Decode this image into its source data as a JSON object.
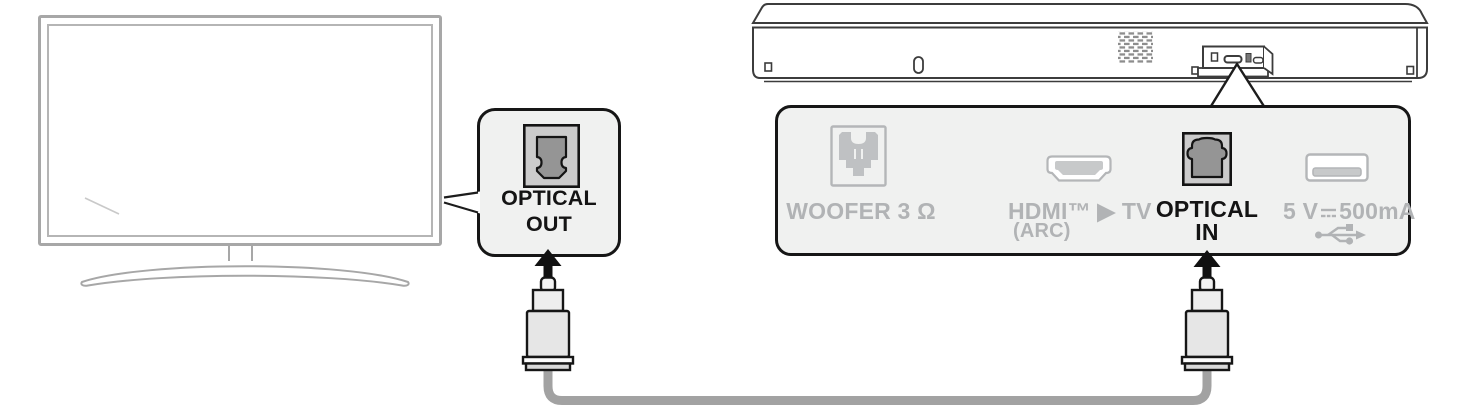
{
  "callout": {
    "line1": "OPTICAL",
    "line2": "OUT"
  },
  "panel": {
    "woofer_label": "WOOFER 3 Ω",
    "hdmi_label": "HDMI™ ▶ TV",
    "hdmi_sublabel": "(ARC)",
    "optical_line1": "OPTICAL",
    "optical_line2": "IN",
    "usb_voltage": "5 V",
    "usb_current": "500mA"
  },
  "icons": {
    "optical_out_port": "toslink-port",
    "optical_in_port": "toslink-port",
    "woofer_port": "woofer-connector",
    "hdmi_port": "hdmi-trapezoid",
    "usb_port": "usb-a-port",
    "usb_symbol": "usb-trident",
    "dc_symbol": "direct-current",
    "arrows": "black-up-arrow"
  },
  "colors": {
    "highlight": "#141414",
    "muted": "#b1b3b5",
    "panel_bg": "#f0f1f0",
    "device_outline": "#3c3c3c",
    "tv_outline": "#a7a7a7",
    "cable": "#a2a2a2"
  }
}
